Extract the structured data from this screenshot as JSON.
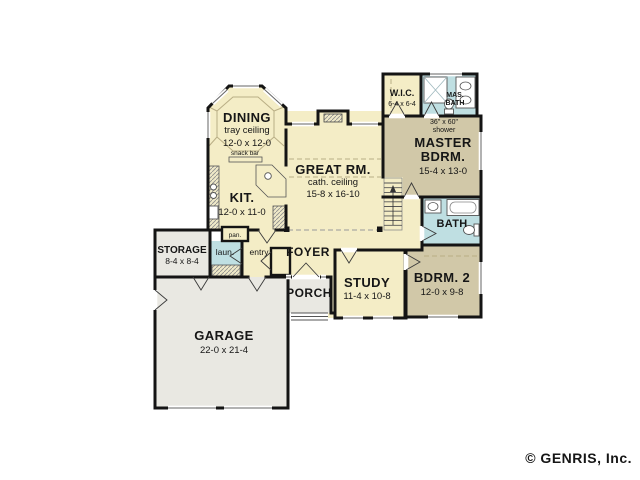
{
  "colors": {
    "cream": "#f4edc6",
    "tan": "#d1c8a8",
    "blue": "#bfdfe2",
    "gray": "#e9e8e2",
    "wall": "#141414",
    "copyright_gray": "#a8a8a8"
  },
  "rooms": {
    "dining": {
      "name": "DINING",
      "ceiling": "tray ceiling",
      "dims": "12-0 x 12-0"
    },
    "snack_bar": {
      "name": "snack bar"
    },
    "kitchen": {
      "name": "KIT.",
      "dims": "12-0 x 11-0"
    },
    "great_room": {
      "name": "GREAT RM.",
      "ceiling": "cath. ceiling",
      "dims": "15-8 x 16-10"
    },
    "wic": {
      "name": "W.I.C.",
      "dims": "6-4 x 6-4"
    },
    "master_bath": {
      "line1": "MAS.",
      "line2": "BATH"
    },
    "shower_note": {
      "line1": "36\" x 60\"",
      "line2": "shower"
    },
    "master_bedroom": {
      "line1": "MASTER",
      "line2": "BDRM.",
      "dims": "15-4 x 13-0"
    },
    "bath": {
      "name": "BATH"
    },
    "bedroom2": {
      "name": "BDRM. 2",
      "dims": "12-0 x 9-8"
    },
    "study": {
      "name": "STUDY",
      "dims": "11-4 x 10-8"
    },
    "foyer": {
      "name": "FOYER"
    },
    "porch": {
      "name": "PORCH"
    },
    "entry": {
      "name": "entry"
    },
    "laundry": {
      "name": "laun."
    },
    "pantry": {
      "name": "pan."
    },
    "storage": {
      "name": "STORAGE",
      "dims": "8-4 x 8-4"
    },
    "garage": {
      "name": "GARAGE",
      "dims": "22-0 x 21-4"
    }
  },
  "footer": {
    "copyright": "© GENRIS, Inc."
  }
}
